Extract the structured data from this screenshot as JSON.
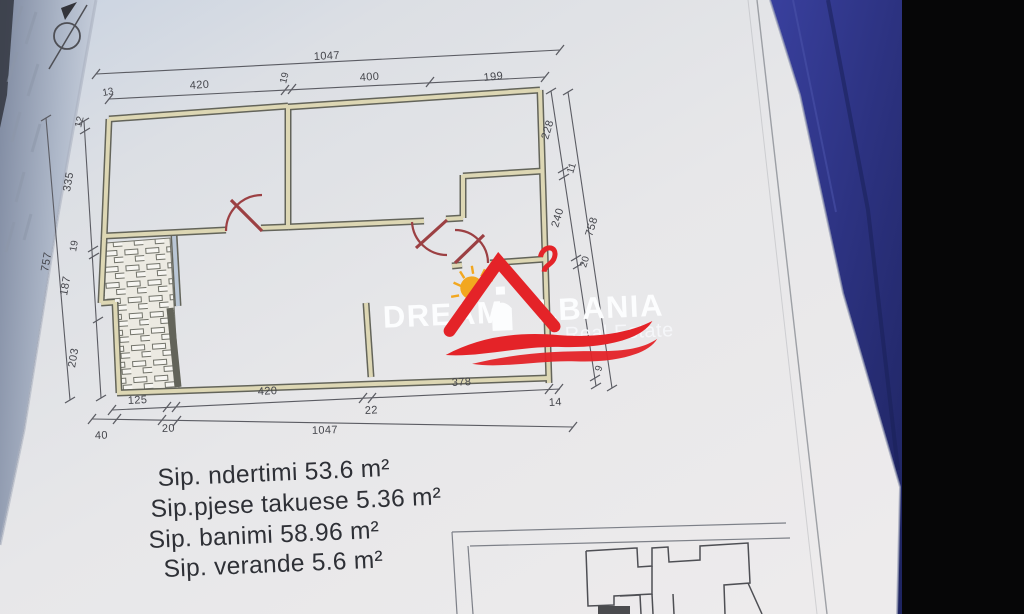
{
  "document": {
    "type": "floor-plan-photo",
    "areas": {
      "line1": "Sip. ndertimi 53.6 m²",
      "line2": "Sip.pjese takuese 5.36  m²",
      "line3": "Sip. banimi  58.96 m²",
      "line4": "Sip. verande   5.6 m²"
    },
    "dims": {
      "top_total": "1047",
      "top_segments": [
        "420",
        "19",
        "400",
        "199"
      ],
      "top_corner": "13",
      "left_thickness": "12",
      "left_segments": [
        "335",
        "19",
        "187",
        "203"
      ],
      "left_total": "757",
      "right_segments": [
        "228",
        "11",
        "240",
        "20",
        "9"
      ],
      "right_total": "758",
      "bottom_row1": [
        "125",
        "420",
        "22",
        "378",
        "14"
      ],
      "bottom_row2": [
        "40",
        "20",
        "1047"
      ]
    },
    "watermark": {
      "brand_left": "DREAM",
      "brand_right": "LBANIA",
      "tagline": "Real Estate"
    },
    "colors": {
      "logo_red": "#e42328",
      "logo_yellow": "#f2a71f",
      "door_red": "#9c4043",
      "wall_fill": "#ddd7b4",
      "fabric_blue": "#2c3280",
      "paper": "#e6e7ea"
    }
  }
}
